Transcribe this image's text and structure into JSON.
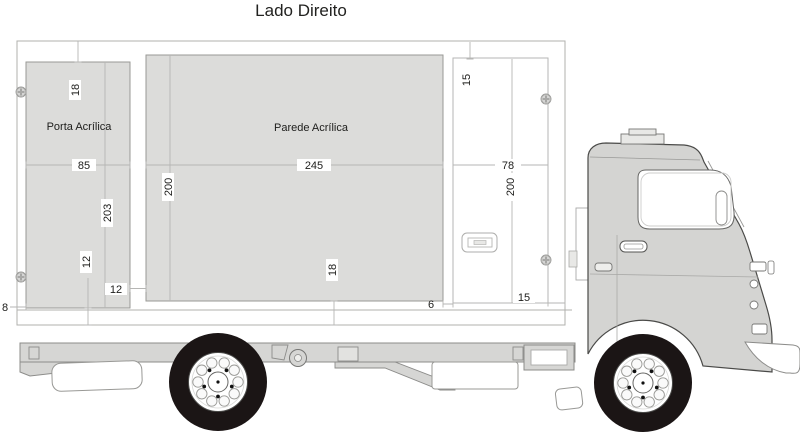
{
  "title": "Lado Direito",
  "panels": {
    "porta": {
      "label": "Porta Acrílica"
    },
    "parede": {
      "label": "Parede Acrílica"
    }
  },
  "dimensions": {
    "porta_top_offset": "18",
    "porta_width": "85",
    "porta_height": "203",
    "porta_bottom_offset": "12",
    "porta_to_parede_gap": "12",
    "left_edge_gap": "8",
    "parede_width": "245",
    "parede_height": "200",
    "parede_bottom_offset": "18",
    "parede_to_door_gap": "6",
    "door_top_offset": "15",
    "door_area_width": "78",
    "door_area_height": "200",
    "right_edge_gap": "15"
  },
  "icons": {
    "fastener": "screw",
    "handle": "recessed-door-handle"
  },
  "colors": {
    "panel_fill": "#dcdcda",
    "cab_fill": "#d4d4d2",
    "chassis_fill": "#d6d6d4",
    "tire": "#1b1515",
    "outline": "#999996",
    "dim_line": "#b6b6b4",
    "text": "#1d1d1b",
    "background": "#ffffff"
  }
}
